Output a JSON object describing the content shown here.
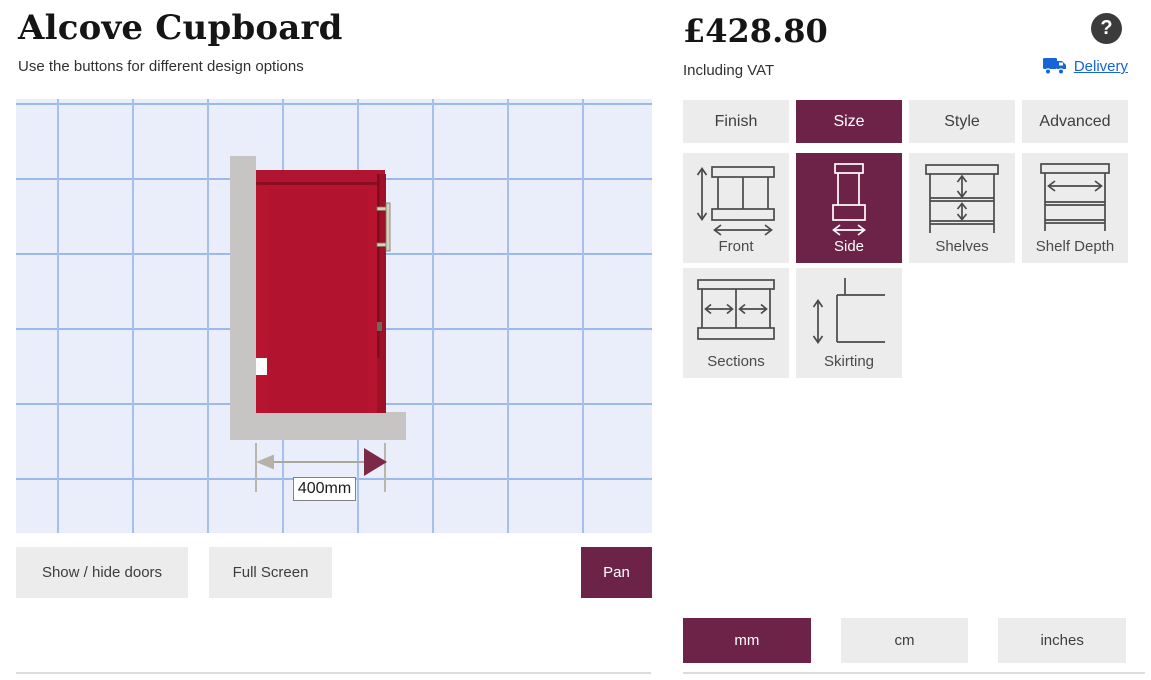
{
  "page": {
    "title": "Alcove Cupboard",
    "subtitle": "Use the buttons for different design options"
  },
  "price": {
    "amount": "£428.80",
    "note": "Including VAT"
  },
  "help": {
    "glyph": "?"
  },
  "links": {
    "delivery": "Delivery"
  },
  "tabs": [
    {
      "label": "Finish",
      "selected": false
    },
    {
      "label": "Size",
      "selected": true
    },
    {
      "label": "Style",
      "selected": false
    },
    {
      "label": "Advanced",
      "selected": false
    }
  ],
  "size_options": [
    {
      "label": "Front",
      "icon": "front-dimension-icon",
      "selected": false
    },
    {
      "label": "Side",
      "icon": "side-dimension-icon",
      "selected": true
    },
    {
      "label": "Shelves",
      "icon": "shelves-dimension-icon",
      "selected": false
    },
    {
      "label": "Shelf Depth",
      "icon": "shelf-depth-dimension-icon",
      "selected": false
    },
    {
      "label": "Sections",
      "icon": "sections-dimension-icon",
      "selected": false
    },
    {
      "label": "Skirting",
      "icon": "skirting-dimension-icon",
      "selected": false
    }
  ],
  "viewer": {
    "dimension_label": "400mm",
    "buttons": [
      {
        "label": "Show / hide doors",
        "selected": false
      },
      {
        "label": "Full Screen",
        "selected": false
      },
      {
        "label": "Pan",
        "selected": true
      }
    ]
  },
  "units": [
    {
      "label": "mm",
      "selected": true
    },
    {
      "label": "cm",
      "selected": false
    },
    {
      "label": "inches",
      "selected": false
    }
  ],
  "colors": {
    "accent": "#6d2347",
    "button_grey": "#ececec",
    "cupboard_red": "#b6142f",
    "cupboard_dark_red": "#9e1126",
    "wall_grey": "#c6c5c3",
    "grid_line_blue": "#a6c0ee",
    "grid_bg_blue": "#e9eefa",
    "link_blue": "#1565d8",
    "help_circle": "#3b3b3b"
  }
}
